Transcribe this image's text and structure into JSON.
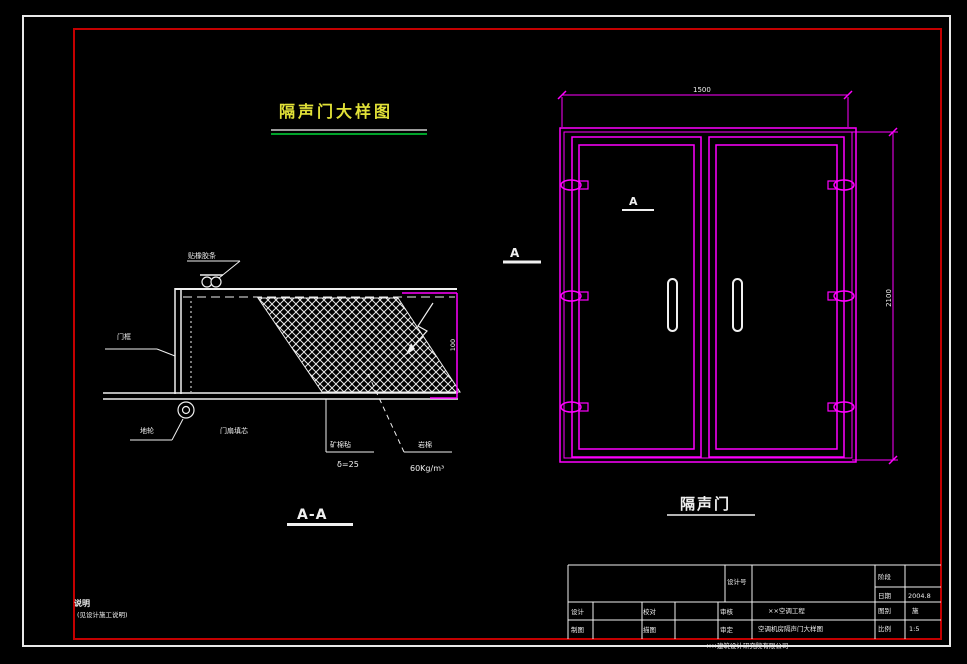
{
  "colors": {
    "background": "#000000",
    "frame_white": "#e9e9e9",
    "frame_red": "#c40000",
    "cad_magenta": "#ff00ff",
    "cad_yellow": "#e2e238",
    "underline_green": "#00a32a"
  },
  "title": {
    "text": "隔声门大样图"
  },
  "section": {
    "caption": "A-A",
    "labels": {
      "top": "贴橡胶条",
      "frame": "门框",
      "floor_wheel": "地轮",
      "leaf": "门扇填芯",
      "absorber_name": "矿棉毡",
      "absorber_thickness": "δ=25",
      "infill_name": "岩棉",
      "infill_density": "60Kg/m³",
      "thickness_dim": "100"
    }
  },
  "elevation": {
    "caption": "隔声门",
    "section_marker": "A",
    "leaf_marker": "A",
    "width_dim": "1500",
    "height_dim": "2100"
  },
  "notes": {
    "heading": "说明",
    "body": "(见设计施工说明)"
  },
  "titleblock": {
    "design_no": "设计号",
    "stage_label": "阶段",
    "date_label": "日期",
    "date_value": "2004.8",
    "type_label": "图别",
    "type_value": "施",
    "scale_label": "比例",
    "scale_value": "1:5",
    "design": "设计",
    "check": "校对",
    "review": "审核",
    "draft": "制图",
    "trace": "描图",
    "approve": "审定",
    "project_line1": "××空调工程",
    "project_line2": "空调机房隔声门大样图"
  },
  "footer": "××建筑设计研究院有限公司"
}
